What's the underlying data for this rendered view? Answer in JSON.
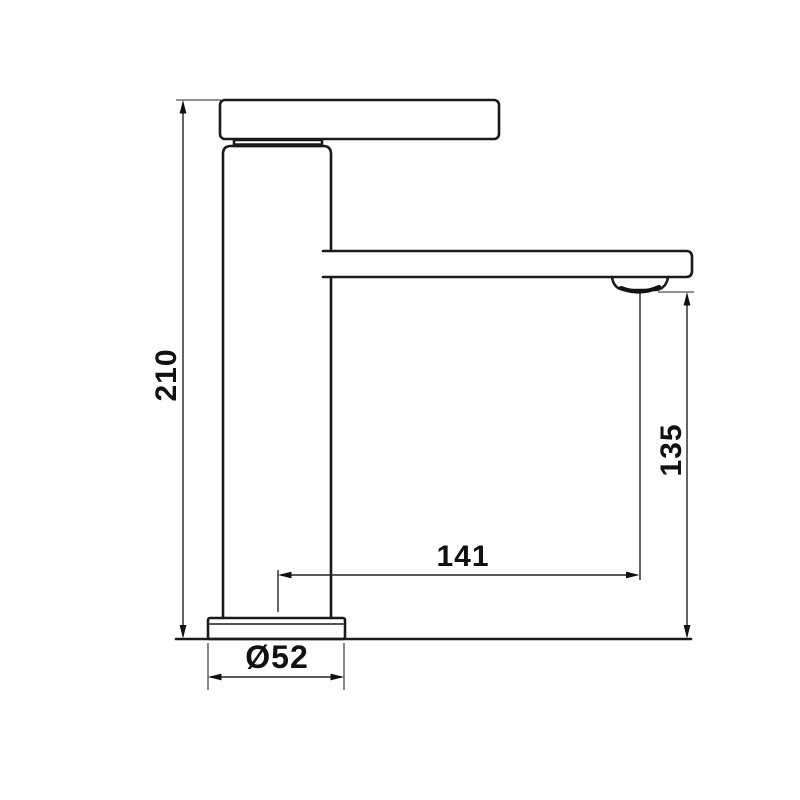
{
  "meta": {
    "drawing_type": "faucet-side-view-technical-drawing",
    "background": "#ffffff"
  },
  "colors": {
    "outline": "#1a1a1a",
    "dimension_lines": "#222222",
    "labels": "#111111"
  },
  "dimensions": {
    "overall_height": "210",
    "spout_height": "135",
    "spout_reach": "141",
    "base_diameter": "Ø52"
  }
}
